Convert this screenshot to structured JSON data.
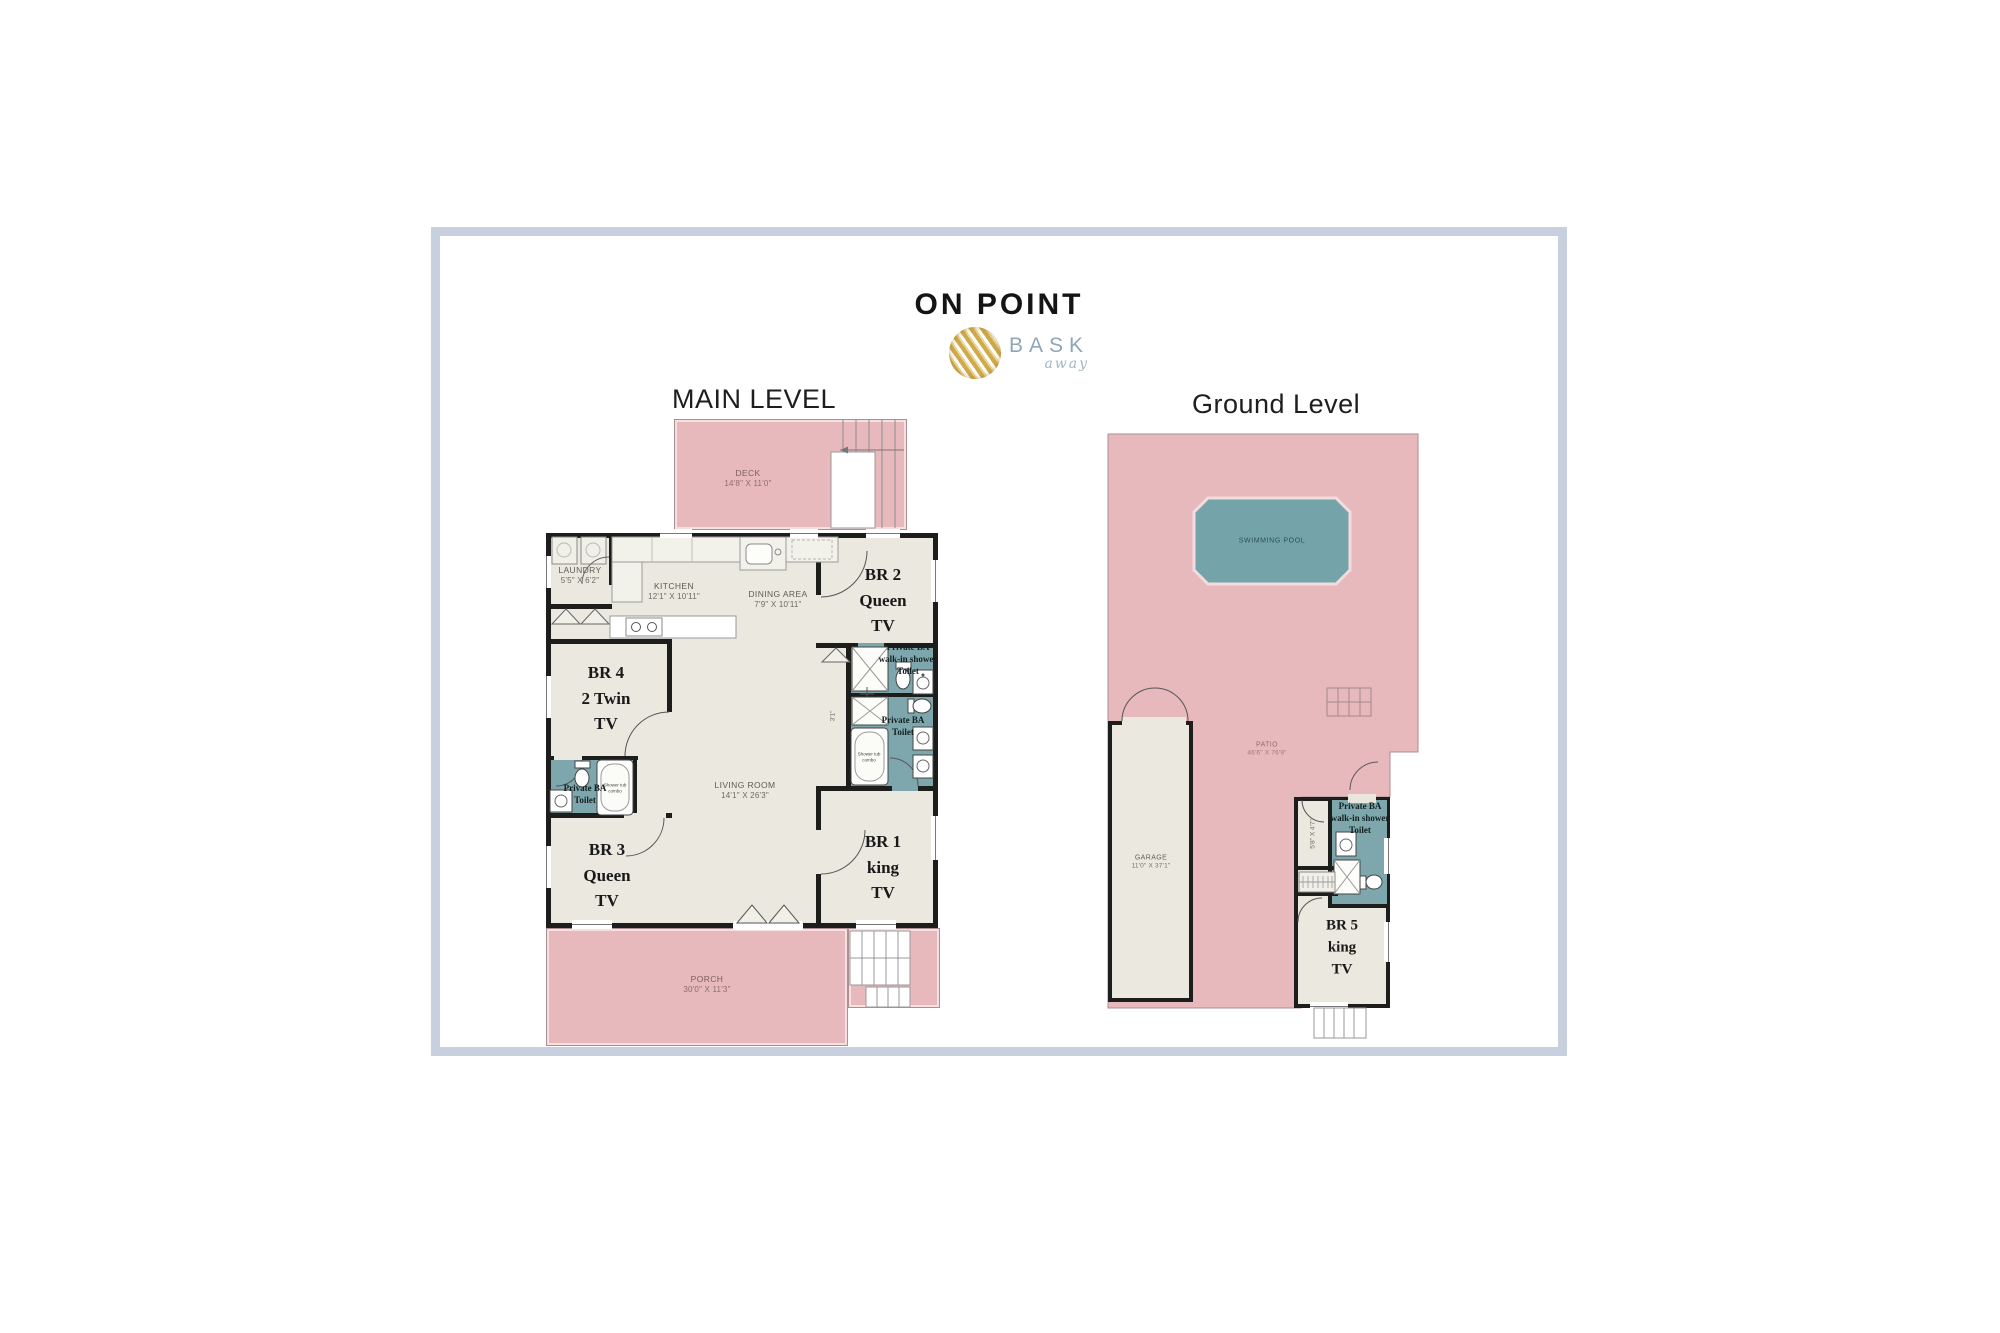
{
  "header": {
    "title": "ON POINT",
    "logo_brand": "BASK",
    "logo_script": "away"
  },
  "levels": {
    "main": "MAIN LEVEL",
    "ground": "Ground Level"
  },
  "colors": {
    "frame": "#c8d0df",
    "outdoor_pink": "#e8b9bc",
    "floor": "#eae8df",
    "wall": "#1d1d1b",
    "bath_teal": "#7da7ac",
    "pool_teal": "#74a4aa",
    "logo_gold": "#cfa94c",
    "brand_blue": "#8fa6b8"
  },
  "main_level": {
    "deck": {
      "name": "DECK",
      "dim": "14'8\" X 11'0\""
    },
    "laundry": {
      "name": "LAUNDRY",
      "dim": "5'5\" X 6'2\""
    },
    "kitchen": {
      "name": "KITCHEN",
      "dim": "12'1\" X 10'11\""
    },
    "dining": {
      "name": "DINING AREA",
      "dim": "7'9\" X 10'11\""
    },
    "living": {
      "name": "LIVING ROOM",
      "dim": "14'1\" X 26'3\""
    },
    "porch": {
      "name": "PORCH",
      "dim": "30'0\" X 11'3\""
    },
    "br2": {
      "l1": "BR 2",
      "l2": "Queen",
      "l3": "TV"
    },
    "br1": {
      "l1": "BR 1",
      "l2": "king",
      "l3": "TV"
    },
    "br4": {
      "l1": "BR 4",
      "l2": "2 Twin",
      "l3": "TV"
    },
    "br3": {
      "l1": "BR 3",
      "l2": "Queen",
      "l3": "TV"
    },
    "ba_br2": {
      "l1": "Private BA",
      "l2": "walk-in shower",
      "l3": "Toilet"
    },
    "ba_br1": {
      "l1": "Private BA",
      "l2": "Toilet"
    },
    "ba_west": {
      "l1": "Private BA",
      "l2": "Toilet"
    },
    "closet_dim": "3'1\"",
    "tub_note": "Shower tub combo"
  },
  "ground_level": {
    "pool": {
      "name": "SWIMMING POOL"
    },
    "patio": {
      "name": "PATIO",
      "dim": "46'6\" X 76'9\""
    },
    "garage": {
      "name": "GARAGE",
      "dim": "11'0\" X 37'1\""
    },
    "br5": {
      "l1": "BR 5",
      "l2": "king",
      "l3": "TV"
    },
    "ba_br5": {
      "l1": "Private BA",
      "l2": "walk-in shower",
      "l3": "Toilet"
    },
    "closet_dim": "5'8\" X 4'7\""
  }
}
